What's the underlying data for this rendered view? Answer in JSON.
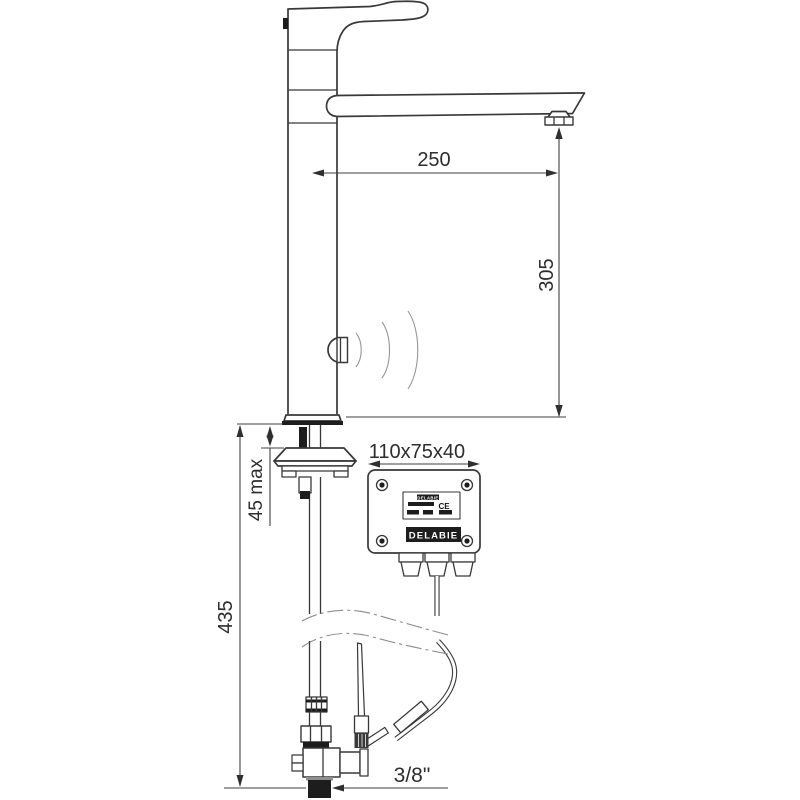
{
  "labels": {
    "spout_reach": "250",
    "aerator_height": "305",
    "box_size": "110x75x40",
    "deck_max": "45 max",
    "under_deck": "435",
    "inlet": "3/8\""
  },
  "control_box": {
    "rating_plate_brand": "DELABIE",
    "rating_plate_ce": "CE",
    "brand_plate": "DELABIE"
  },
  "colors": {
    "line": "#383838",
    "dark_fill": "#1d1d1d",
    "wave_gray": "#979797",
    "background": "#ffffff"
  }
}
